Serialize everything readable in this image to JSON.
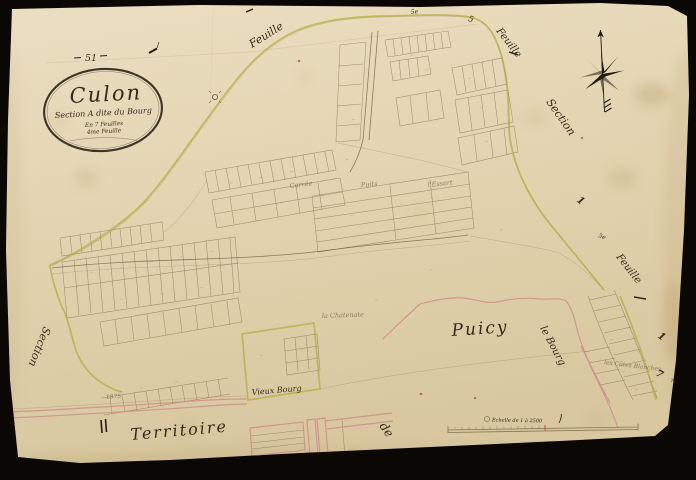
{
  "page": {
    "number": "51"
  },
  "cartouche": {
    "title": "Culon",
    "line2": "Section A dite du Bourg",
    "line3": "En 7 Feuilles",
    "line4": "4me Feuille"
  },
  "edge_labels": {
    "top_feuille": "Feuille",
    "top_right_5e": "5e",
    "top_right_5": "5",
    "right_feuille_upper": "Feuille",
    "right_section": "Section",
    "right_5e": "5e",
    "right_feuille_lower": "Feuille",
    "left_section": "Section"
  },
  "numerals": {
    "upper_right_1": "1",
    "lower_right_1": "1",
    "right_7": "7",
    "right_7e": "7e"
  },
  "place_labels": {
    "puicy": "Puicy",
    "le_bourg": "le Bourg",
    "vieux_bourg": "Vieux Bourg",
    "territoire": "Territoire",
    "de": "de",
    "carree": "Carrée",
    "puits": "Puits",
    "essart": "l'Essart",
    "chatenaie": "la Chatenate",
    "cotes_blanches": "les Côtes Blanches",
    "year": "1875"
  },
  "scale": {
    "label": "Echelle de 1 à 2500"
  },
  "colors": {
    "background": "#090603",
    "paper": "#e6d9b6",
    "ink": "#7a6648",
    "boundary_yellow": "#b5ad3c",
    "boundary_pink": "#cf8d8a",
    "accent_red": "#b05545"
  }
}
